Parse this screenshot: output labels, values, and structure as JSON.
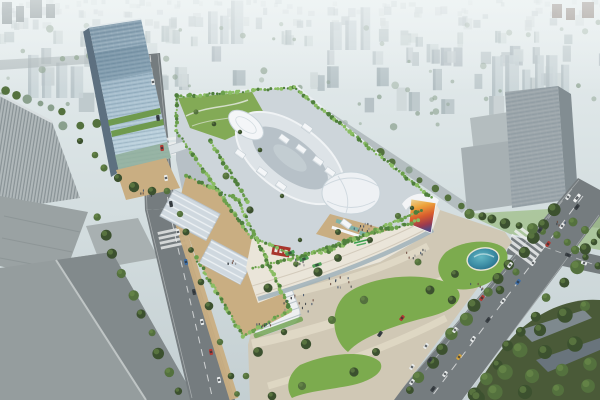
{
  "meta": {
    "kind": "architectural-aerial-rendering",
    "description": "Aerial rendering of a shopping mall complex with rooftop gardens, oval roof plaza, white canopy domes, a glass office tower, surrounding roads with traffic, entrance plaza with lawns and pond, in a hazy city",
    "signage": {
      "mall_logo": "green script logo on curved white facade (illegible)",
      "corner_sign": "red sign with white characters on facade corner (illegible)",
      "led_screen": "large curved multicolor LED billboard on mall corner"
    }
  },
  "scene": {
    "colors": {
      "sky_top": "#e7eeef",
      "sky_mid": "#d3dddf",
      "sky_low": "#c4cfd2",
      "haze": "#f3f7f7",
      "bg_b1": "#c9d2d4",
      "bg_b2": "#bdc8cb",
      "bg_b3": "#b4c0c4",
      "bg_b4": "#d0d9da",
      "bg_side": "#9fadb2",
      "bg_tree": "#8aa08d",
      "cluster_t": "#c9d4d7",
      "dark_tower_l": "#707c80",
      "dark_tower_r": "#7a6a62",
      "bg_road": "#a2abae",
      "tower_glass_top": "#7f98a9",
      "tower_glass_mid": "#a3bccc",
      "tower_glass_low": "#bed4df",
      "tower_side": "#5d7080",
      "tower_band": "#4d6a82",
      "tower_green": "#6f9a4e",
      "tower_base_glass": "#8fae9a",
      "tower_roof_edge": "#e2e9ec",
      "mall_under": "#b7c0c6",
      "mall_roof": "#cdd5da",
      "mall_roof_edge": "#eaeff1",
      "track_outer": "#dde3e7",
      "track_inner": "#b7c1c8",
      "track_core": "#c6cfd5",
      "track_rim": "#f0f3f5",
      "dome": "#eef1f4",
      "dome_line": "#c9d4da",
      "canopy": "#f4f6f8",
      "canopy_shadow": "#c3cdd3",
      "garden": "#83aa56",
      "garden_path": "#dde3d6",
      "hedge1": "#4f7f3c",
      "hedge2": "#6ba04c",
      "hedge3": "#8abd63",
      "terrace": "#c9ae82",
      "terrace_dark": "#b2926a",
      "skylight": "#cfd8df",
      "skylight_edge": "#b9c3cb",
      "roofbox": "#bcc6cc",
      "facade": "#eae5d9",
      "facade_line": "#d0c8b8",
      "facade_glass": "#9fb2ba",
      "pav_roof": "#eef0f1",
      "pav_line": "#aab6bd",
      "teal_canopy": "#7fb3a9",
      "logo_green": "#38a04b",
      "sign_red": "#a8352c",
      "sign_white": "#f2f2f2",
      "led_a": "#ecd9a0",
      "led_b": "#eda43c",
      "led_c": "#d85c2d",
      "led_d": "#9c3a4e",
      "led_e": "#57497e",
      "plaza": "#d0c8b5",
      "plaza_path": "#e0d9c6",
      "lawn": "#7cab4e",
      "lawn_dark": "#5c8a3c",
      "pond_edge": "#e9e5d5",
      "pond_deep": "#1f6080",
      "pond_mid": "#3e8fa6",
      "pond_light": "#63b7c4",
      "pond_glint": "#bfe0e4",
      "road": "#757c7f",
      "lane": "#eceeee",
      "fgA": "#9aa2a3",
      "fgA_dark": "#868e8f",
      "fgB": "#959d9e",
      "fgB_dark": "#828a8c",
      "fgB_ridge": "#bfc5c5",
      "fg_annex": "#a8b0b1",
      "striped": "#b0b8ba",
      "striped_edge": "#d8dee0",
      "rightb": "#9ba5aa",
      "rightb_side": "#828d92",
      "rightb_wing": "#a7b0b3",
      "rightb_low": "#b4bdbf",
      "corner_roof1": "#7e898e",
      "corner_roof2": "#69747c",
      "corner_green": "#4a5a38",
      "tree_dark": "#3c512f",
      "tree_mid": "#54713e",
      "tree_lite": "#6f8f4c",
      "car_white": "#e9ecec",
      "car_dark": "#3c4246",
      "car_red": "#b23b35",
      "car_blue": "#3d6da5",
      "car_yellow": "#d7a53c",
      "bus_green": "#4f9e55",
      "bus_white": "#eef0f0",
      "car_glass": "#2c3338",
      "bridge": "#dce3e6",
      "ped1": "#3a4046",
      "ped2": "#6b4a3e",
      "ped3": "#44546b",
      "ped4": "#8c8c8c"
    },
    "background": {
      "rows": [
        {
          "y": 6,
          "n": 46,
          "w": [
            3,
            7
          ],
          "h": [
            3,
            7
          ],
          "o": 0.4
        },
        {
          "y": 16,
          "n": 40,
          "w": [
            4,
            8
          ],
          "h": [
            4,
            9
          ],
          "o": 0.5
        },
        {
          "y": 28,
          "n": 34,
          "w": [
            5,
            9
          ],
          "h": [
            6,
            12
          ],
          "o": 0.62
        },
        {
          "y": 44,
          "n": 30,
          "w": [
            5,
            11
          ],
          "h": [
            8,
            16
          ],
          "o": 0.72
        },
        {
          "y": 64,
          "n": 26,
          "w": [
            6,
            12
          ],
          "h": [
            10,
            20
          ],
          "o": 0.82
        },
        {
          "y": 88,
          "n": 20,
          "w": [
            7,
            14
          ],
          "h": [
            12,
            22
          ],
          "o": 0.9
        },
        {
          "y": 112,
          "n": 12,
          "w": [
            8,
            16
          ],
          "h": [
            14,
            24
          ],
          "o": 0.95
        }
      ],
      "trees": {
        "n": 70,
        "y0": 22,
        "y1": 130
      },
      "clusters": [
        [
          492,
          96,
          6
        ],
        [
          28,
          98,
          4
        ],
        [
          208,
          44,
          3
        ],
        [
          330,
          50,
          3
        ]
      ],
      "darkTowers": [
        [
          2,
          2,
          10,
          22,
          "dark_tower_l"
        ],
        [
          16,
          6,
          8,
          16,
          "dark_tower_l"
        ],
        [
          30,
          0,
          12,
          18,
          "dark_tower_l"
        ],
        [
          46,
          4,
          9,
          14,
          "dark_tower_l"
        ],
        [
          552,
          4,
          10,
          14,
          "dark_tower_r"
        ],
        [
          566,
          8,
          9,
          12,
          "dark_tower_r"
        ],
        [
          582,
          2,
          12,
          16,
          "dark_tower_r"
        ]
      ]
    },
    "treeRows": [
      {
        "x1": 556,
        "y1": 210,
        "x2": 408,
        "y2": 390,
        "n": 14,
        "s": 5.5,
        "layer": "fg"
      },
      {
        "x1": 600,
        "y1": 234,
        "x2": 472,
        "y2": 396,
        "n": 11,
        "s": 6,
        "layer": "fg"
      },
      {
        "x1": 468,
        "y1": 214,
        "x2": 556,
        "y2": 236,
        "n": 8,
        "s": 4.5,
        "layer": "fg"
      },
      {
        "x1": 566,
        "y1": 242,
        "x2": 598,
        "y2": 266,
        "n": 4,
        "s": 4.5,
        "layer": "fg"
      },
      {
        "x1": 96,
        "y1": 216,
        "x2": 178,
        "y2": 392,
        "n": 10,
        "s": 5,
        "layer": "fg"
      },
      {
        "x1": 4,
        "y1": 90,
        "x2": 62,
        "y2": 112,
        "n": 6,
        "s": 4,
        "layer": "bg"
      },
      {
        "x1": 0,
        "y1": 130,
        "x2": 128,
        "y2": 122,
        "n": 9,
        "s": 4,
        "layer": "bg"
      },
      {
        "x1": 298,
        "y1": 100,
        "x2": 462,
        "y2": 206,
        "n": 13,
        "s": 3.5,
        "layer": "bg"
      },
      {
        "x1": 62,
        "y1": 58,
        "x2": 140,
        "y2": 54,
        "n": 7,
        "s": 3.5,
        "layer": "bg"
      }
    ],
    "treeSingles": [
      [
        104,
        168,
        5
      ],
      [
        118,
        178,
        5
      ],
      [
        134,
        187,
        5
      ],
      [
        152,
        191,
        5
      ],
      [
        167,
        191,
        4
      ],
      [
        95,
        155,
        4
      ],
      [
        80,
        141,
        4
      ],
      [
        180,
        214,
        3.5
      ],
      [
        186,
        232,
        3.5
      ],
      [
        191,
        250,
        3.5
      ],
      [
        201,
        282,
        3.5
      ],
      [
        209,
        306,
        4
      ],
      [
        220,
        342,
        4
      ],
      [
        231,
        376,
        4
      ],
      [
        237,
        394,
        4
      ],
      [
        268,
        288,
        4.5
      ],
      [
        318,
        272,
        4
      ],
      [
        296,
        264,
        3.5
      ],
      [
        338,
        258,
        3.5
      ],
      [
        364,
        300,
        4.5
      ],
      [
        332,
        320,
        4.5
      ],
      [
        306,
        344,
        4.5
      ],
      [
        284,
        332,
        4
      ],
      [
        258,
        352,
        4.5
      ],
      [
        246,
        376,
        4.5
      ],
      [
        430,
        290,
        4
      ],
      [
        452,
        300,
        4
      ],
      [
        418,
        262,
        3.5
      ],
      [
        376,
        352,
        4.5
      ],
      [
        354,
        372,
        4.5
      ],
      [
        302,
        386,
        4
      ],
      [
        272,
        396,
        4
      ],
      [
        455,
        274,
        4
      ],
      [
        500,
        290,
        4
      ],
      [
        516,
        272,
        4
      ],
      [
        540,
        330,
        7
      ],
      [
        565,
        315,
        7
      ],
      [
        585,
        306,
        6
      ],
      [
        520,
        350,
        7
      ],
      [
        545,
        352,
        7
      ],
      [
        575,
        344,
        7
      ],
      [
        505,
        372,
        8
      ],
      [
        532,
        376,
        7
      ],
      [
        562,
        370,
        7
      ],
      [
        590,
        364,
        7
      ],
      [
        495,
        392,
        8
      ],
      [
        525,
        392,
        7
      ],
      [
        558,
        390,
        7
      ],
      [
        588,
        386,
        7
      ],
      [
        478,
        398,
        7
      ],
      [
        573,
        222,
        4
      ],
      [
        585,
        230,
        4
      ],
      [
        594,
        242,
        4
      ],
      [
        196,
        112,
        3
      ],
      [
        214,
        124,
        3
      ],
      [
        240,
        132,
        3
      ],
      [
        260,
        150,
        3
      ],
      [
        282,
        196,
        3
      ],
      [
        250,
        210,
        3
      ],
      [
        226,
        176,
        3
      ],
      [
        338,
        232,
        3
      ],
      [
        300,
        240,
        3
      ],
      [
        370,
        240,
        3
      ],
      [
        398,
        216,
        3
      ],
      [
        412,
        208,
        3
      ]
    ],
    "hedges": [
      [
        178,
        97,
        294,
        87
      ],
      [
        294,
        87,
        432,
        198
      ],
      [
        176,
        130,
        204,
        171
      ],
      [
        204,
        171,
        251,
        237
      ],
      [
        251,
        237,
        299,
        257
      ],
      [
        299,
        257,
        351,
        239
      ],
      [
        351,
        239,
        418,
        221
      ],
      [
        186,
        176,
        238,
        200
      ],
      [
        238,
        200,
        290,
        310
      ],
      [
        290,
        310,
        244,
        336
      ],
      [
        196,
        258,
        243,
        336
      ],
      [
        253,
        268,
        328,
        251
      ],
      [
        328,
        251,
        422,
        210
      ],
      [
        210,
        140,
        248,
        202
      ],
      [
        118,
        166,
        172,
        184
      ],
      [
        176,
        96,
        176,
        130
      ]
    ],
    "canopies": [
      [
        284,
        139
      ],
      [
        301,
        149
      ],
      [
        318,
        161
      ],
      [
        262,
        172
      ],
      [
        281,
        186
      ],
      [
        240,
        154
      ],
      [
        330,
        172
      ],
      [
        307,
        128
      ],
      [
        346,
        224
      ]
    ],
    "cars": [
      [
        153,
        82,
        83,
        "car_white"
      ],
      [
        158,
        118,
        83,
        "car_dark"
      ],
      [
        162,
        148,
        83,
        "car_red"
      ],
      [
        166,
        178,
        83,
        "car_white"
      ],
      [
        171,
        204,
        80,
        "car_dark"
      ],
      [
        178,
        232,
        78,
        "car_white"
      ],
      [
        186,
        262,
        78,
        "car_blue"
      ],
      [
        194,
        292,
        78,
        "car_dark"
      ],
      [
        202,
        322,
        78,
        "car_white"
      ],
      [
        211,
        352,
        78,
        "car_red"
      ],
      [
        219,
        380,
        78,
        "car_white"
      ],
      [
        577,
        207,
        127,
        "car_dark"
      ],
      [
        562,
        226,
        127,
        "car_white"
      ],
      [
        548,
        244,
        127,
        "car_red"
      ],
      [
        533,
        263,
        127,
        "car_white"
      ],
      [
        518,
        282,
        127,
        "car_blue"
      ],
      [
        503,
        301,
        127,
        "car_white"
      ],
      [
        488,
        320,
        127,
        "car_dark"
      ],
      [
        473,
        339,
        127,
        "car_white"
      ],
      [
        459,
        357,
        127,
        "car_yellow"
      ],
      [
        445,
        374,
        127,
        "car_white"
      ],
      [
        433,
        389,
        127,
        "car_dark"
      ],
      [
        568,
        197,
        127,
        "car_white"
      ],
      [
        540,
        230,
        127,
        "car_dark"
      ],
      [
        510,
        265,
        127,
        "car_white"
      ],
      [
        482,
        298,
        127,
        "car_red"
      ],
      [
        455,
        330,
        127,
        "car_white"
      ],
      [
        430,
        360,
        127,
        "car_dark"
      ],
      [
        412,
        382,
        127,
        "car_white"
      ],
      [
        584,
        263,
        20,
        "car_white"
      ],
      [
        568,
        255,
        20,
        "car_dark"
      ],
      [
        402,
        318,
        127,
        "car_red"
      ],
      [
        426,
        346,
        127,
        "car_white"
      ],
      [
        412,
        367,
        127,
        "car_white"
      ],
      [
        380,
        334,
        125,
        "car_dark"
      ]
    ],
    "buses": [
      [
        304,
        259,
        -20,
        "bus_green"
      ],
      [
        317,
        265,
        -18,
        "bus_green"
      ],
      [
        290,
        253,
        -22,
        "bus_green"
      ],
      [
        577,
        198,
        127,
        "bus_white"
      ]
    ],
    "pedestrians": {
      "palette": [
        "ped1",
        "ped2",
        "ped3",
        "ped4"
      ],
      "clusters": [
        [
          298,
          302,
          14,
          30
        ],
        [
          262,
          326,
          8,
          18
        ],
        [
          340,
          282,
          10,
          24
        ],
        [
          416,
          252,
          8,
          20
        ],
        [
          300,
          262,
          6,
          14
        ],
        [
          232,
          262,
          5,
          10
        ],
        [
          362,
          228,
          12,
          20
        ],
        [
          145,
          192,
          5,
          12
        ],
        [
          560,
          222,
          4,
          10
        ],
        [
          476,
          286,
          5,
          14
        ]
      ]
    }
  }
}
